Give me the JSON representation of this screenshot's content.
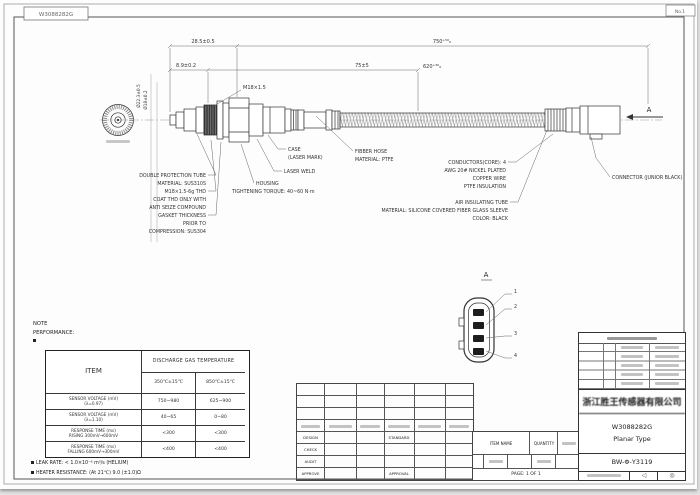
{
  "sheet": {
    "doc_no_box": "W3088282G",
    "sheet_no": "No.1"
  },
  "dims": {
    "overall": "750⁺⁵⁰₀",
    "cable": "620⁺³⁰₀",
    "tip_len": "28.5±0.5",
    "tip_small": "8.9±0.2",
    "hose": "75±5",
    "thread": "M18×1.5",
    "dia_hex": "Ø22.3±0.5",
    "dia_thread": "Ø18±0.2",
    "section": "A"
  },
  "callouts": {
    "left": [
      "DOUBLE PROTECTION TUBE",
      "MATERIAL: SUS310S",
      "M18×1.5-6g THD",
      "COAT THD ONLY WITH",
      "ANTI SEIZE COMPOUND",
      "GASKET THICKNESS",
      "PRIOR TO",
      "COMPRESSION: SUS304"
    ],
    "case": [
      "CASE",
      "(LASER MARK)"
    ],
    "laser_weld": "LASER WELD",
    "hose": [
      "FIBBER HOSE",
      "MATERIAL: PTFE"
    ],
    "housing": [
      "HOUSING",
      "TIGHTENING TORQUE: 40~60 N·m"
    ],
    "air_tube": [
      "AIR INSULATING TUBE",
      "MATERIAL: SILICONE COVERED FIBER GLASS SLEEVE",
      "COLOR: BLACK"
    ],
    "conductors": [
      "CONDUCTORS(CORE): 4",
      "AWG 20# NICKEL PLATED",
      "COPPER WIRE",
      "PTFE INSULATION"
    ],
    "connector": "CONNECTOR (JUNIOR BLACK)"
  },
  "detail_a": {
    "label": "A",
    "pins": [
      "1",
      "2",
      "3",
      "4"
    ]
  },
  "notes": {
    "note": "NOTE",
    "performance": "PERFORMANCE:",
    "leak": "LEAK RATE: < 1.0×10⁻⁶ m³/s (HELIUM)",
    "heater": "HEATER RESISTANCE: (At 21℃) 9.0 (±1.0)Ω"
  },
  "perf_table": {
    "item_header": "ITEM",
    "group_header": "DISCHARGE GAS TEMPERATURE",
    "col1": "350℃±15℃",
    "col2": "850℃±15℃",
    "rows": [
      {
        "item1": "SENSOR VOLTAGE (mV)",
        "item2": "(λ=0.97)",
        "v1": "750~980",
        "v2": "625~900"
      },
      {
        "item1": "SENSOR VOLTAGE (mV)",
        "item2": "(λ=1.10)",
        "v1": "40~65",
        "v2": "0~80"
      },
      {
        "item1": "RESPONSE TIME (ms)",
        "item2": "RISING 300mV→600mV",
        "v1": "<300",
        "v2": "<300"
      },
      {
        "item1": "RESPONSE TIME (ms)",
        "item2": "FALLING 600mV→300mV",
        "v1": "<400",
        "v2": "<400"
      }
    ]
  },
  "approval": {
    "rows": [
      "DESIGN",
      "CHECK",
      "AUDIT",
      "APPROVE"
    ],
    "design_note": "STANDARD",
    "approve_note": "APPROVAL"
  },
  "parts_strip": {
    "item_name": "ITEM NAME",
    "quantity": "QUANTITY",
    "page": "PAGE: 1 OF 1"
  },
  "title_block": {
    "company": "浙江胜王传感器有限公司",
    "part_no": "W3088282G",
    "part_type": "Planar Type",
    "drawing_no": "BW-Φ-Y3119",
    "proj_symbol": "◁",
    "std_symbol": "◎"
  }
}
